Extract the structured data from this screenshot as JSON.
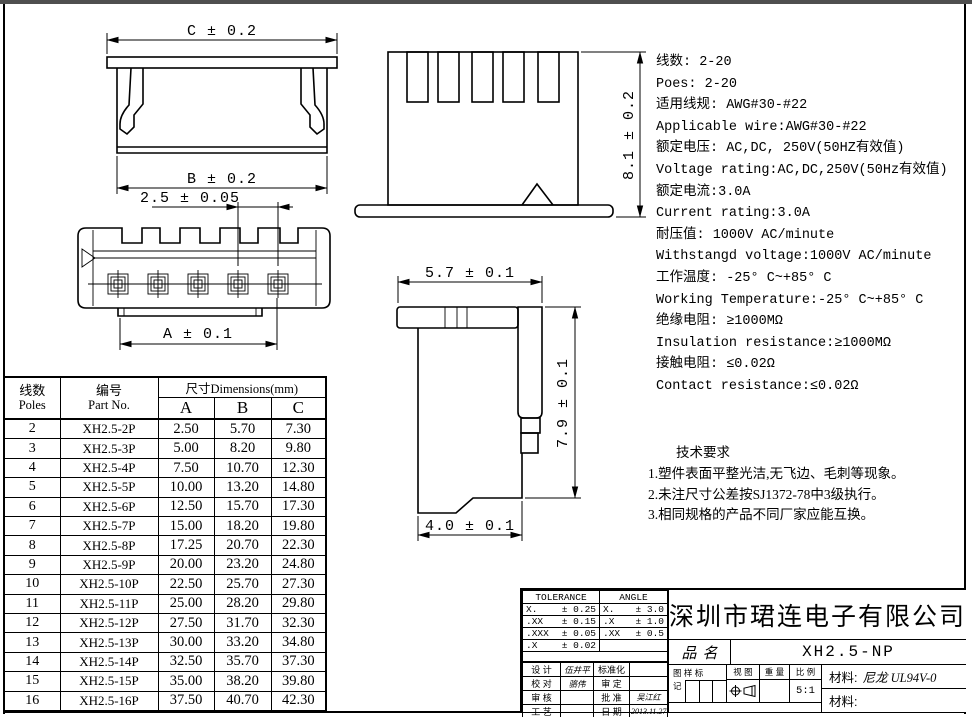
{
  "drawing": {
    "front_view": {
      "dim_c": "C ± 0.2",
      "dim_b": "B ± 0.2"
    },
    "back_view": {
      "dim_pitch": "2.5 ± 0.05",
      "dim_a": "A ± 0.1"
    },
    "top_view": {
      "dim_height": "8.1 ± 0.2"
    },
    "side_view": {
      "dim_width": "5.7 ± 0.1",
      "dim_depth": "7.9 ± 0.1",
      "dim_tail": "4.0 ± 0.1"
    }
  },
  "specs": {
    "lines": [
      "线数: 2-20",
      "Poes: 2-20",
      "适用线规: AWG#30-#22",
      "Applicable wire:AWG#30-#22",
      "额定电压: AC,DC, 250V(50HZ有效值)",
      "Voltage rating:AC,DC,250V(50Hz有效值)",
      "额定电流:3.0A",
      "Current rating:3.0A",
      "耐压值: 1000V AC/minute",
      "Withstangd voltage:1000V AC/minute",
      "工作温度: -25° C~+85° C",
      "Working Temperature:-25° C~+85° C",
      "绝缘电阻: ≥1000MΩ",
      "Insulation resistance:≥1000MΩ",
      "接触电阻: ≤0.02Ω",
      "Contact resistance:≤0.02Ω"
    ]
  },
  "tech_requirements": {
    "title": "技术要求",
    "items": [
      "1.塑件表面平整光洁,无飞边、毛刺等现象。",
      "2.未注尺寸公差按SJ1372-78中3级执行。",
      "3.相同规格的产品不同厂家应能互换。"
    ]
  },
  "table": {
    "header": {
      "poles_cn": "线数",
      "poles_en": "Poles",
      "part_cn": "编号",
      "part_en": "Part No.",
      "dims_label": "尺寸Dimensions(mm)",
      "col_a": "A",
      "col_b": "B",
      "col_c": "C"
    },
    "rows": [
      [
        "2",
        "XH2.5-2P",
        "2.50",
        "5.70",
        "7.30"
      ],
      [
        "3",
        "XH2.5-3P",
        "5.00",
        "8.20",
        "9.80"
      ],
      [
        "4",
        "XH2.5-4P",
        "7.50",
        "10.70",
        "12.30"
      ],
      [
        "5",
        "XH2.5-5P",
        "10.00",
        "13.20",
        "14.80"
      ],
      [
        "6",
        "XH2.5-6P",
        "12.50",
        "15.70",
        "17.30"
      ],
      [
        "7",
        "XH2.5-7P",
        "15.00",
        "18.20",
        "19.80"
      ],
      [
        "8",
        "XH2.5-8P",
        "17.25",
        "20.70",
        "22.30"
      ],
      [
        "9",
        "XH2.5-9P",
        "20.00",
        "23.20",
        "24.80"
      ],
      [
        "10",
        "XH2.5-10P",
        "22.50",
        "25.70",
        "27.30"
      ],
      [
        "11",
        "XH2.5-11P",
        "25.00",
        "28.20",
        "29.80"
      ],
      [
        "12",
        "XH2.5-12P",
        "27.50",
        "31.70",
        "32.30"
      ],
      [
        "13",
        "XH2.5-13P",
        "30.00",
        "33.20",
        "34.80"
      ],
      [
        "14",
        "XH2.5-14P",
        "32.50",
        "35.70",
        "37.30"
      ],
      [
        "15",
        "XH2.5-15P",
        "35.00",
        "38.20",
        "39.80"
      ],
      [
        "16",
        "XH2.5-16P",
        "37.50",
        "40.70",
        "42.30"
      ]
    ]
  },
  "titleblock": {
    "tolerance_title": "TOLERANCE",
    "angle_title": "ANGLE",
    "tolerance_rows": [
      [
        "X.",
        "± 0.25",
        "X.",
        "± 3.0"
      ],
      [
        ".XX",
        "± 0.15",
        ".X",
        "± 1.0"
      ],
      [
        ".XXX",
        "± 0.05",
        ".XX",
        "± 0.5"
      ],
      [
        ".X",
        "± 0.02",
        "",
        ""
      ]
    ],
    "signature_rows": [
      [
        "设 计",
        "伍井平",
        "标准化",
        ""
      ],
      [
        "校 对",
        "骆伟",
        "审 定",
        ""
      ],
      [
        "审 核",
        "",
        "批 准",
        "吴江红"
      ],
      [
        "工 艺",
        "",
        "日 期",
        "2013.11.27"
      ]
    ],
    "company": "深圳市珺连电子有限公司",
    "product_label": "品名",
    "product_name": "XH2.5-NP",
    "stamp_label": "图 样 标",
    "stamp_label_2": "记",
    "view_label": "视 图",
    "weight_label": "重 量",
    "scale_label": "比 例",
    "scale_value": "5:1",
    "material_label": "材料:",
    "material_value": "尼龙 UL94V-0",
    "material_label_2": "材料:"
  }
}
